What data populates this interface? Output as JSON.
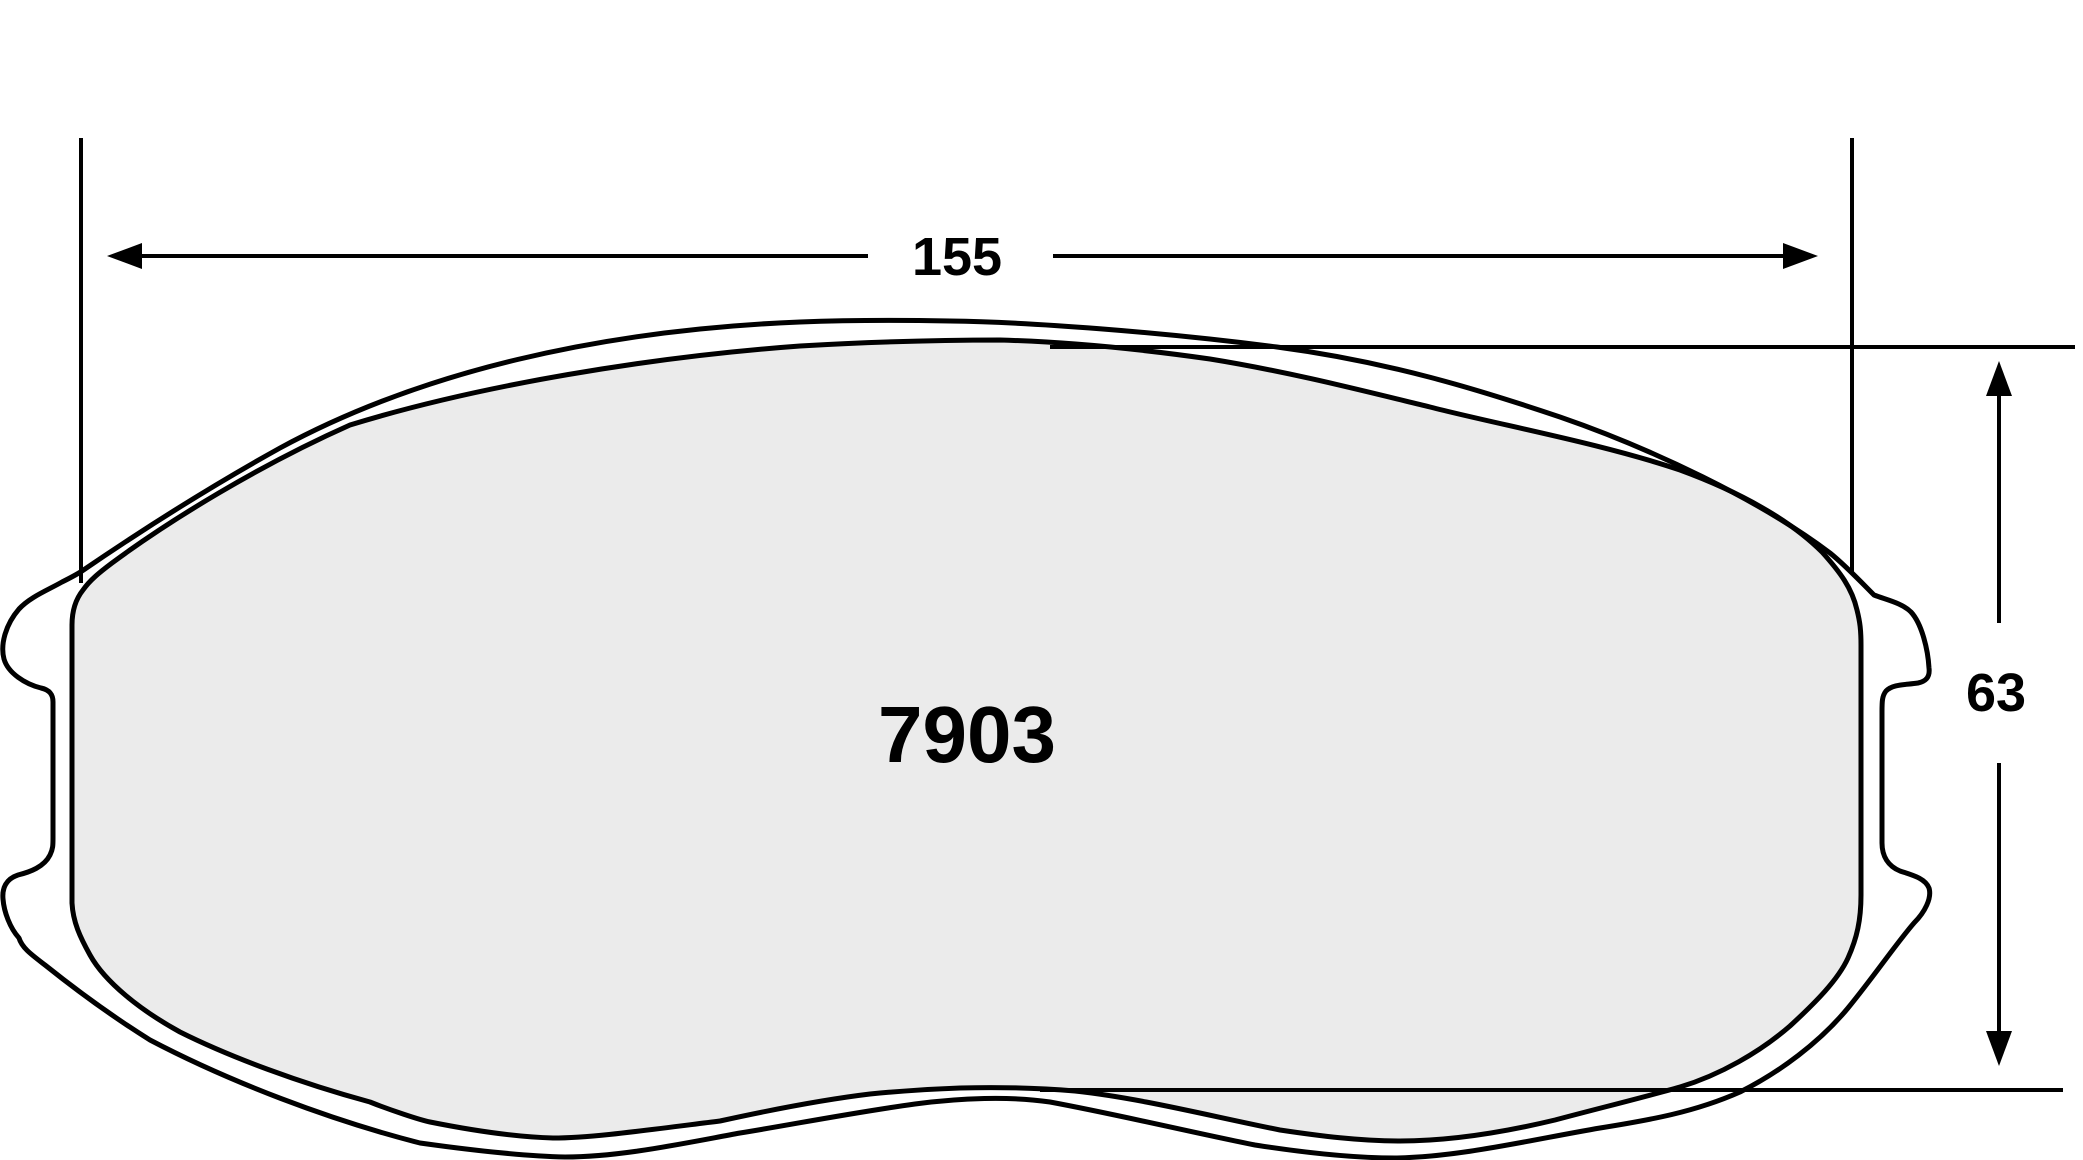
{
  "drawing": {
    "kind": "brake-pad-technical-drawing",
    "part_number": "7903",
    "dimensions": {
      "width_label": "155",
      "height_label": "63"
    },
    "colors": {
      "pad_fill": "#ebebeb",
      "line": "#000000",
      "background": "#ffffff"
    }
  }
}
